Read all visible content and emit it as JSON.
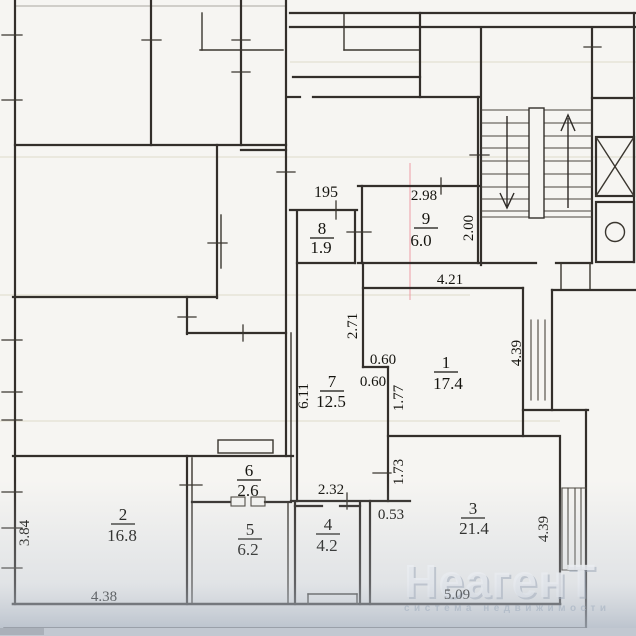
{
  "apartment_number": "195",
  "rooms": [
    {
      "number": "1",
      "area": "17.4"
    },
    {
      "number": "2",
      "area": "16.8"
    },
    {
      "number": "3",
      "area": "21.4"
    },
    {
      "number": "4",
      "area": "4.2"
    },
    {
      "number": "5",
      "area": "6.2"
    },
    {
      "number": "6",
      "area": "2.6"
    },
    {
      "number": "7",
      "area": "12.5"
    },
    {
      "number": "8",
      "area": "1.9"
    },
    {
      "number": "9",
      "area": "6.0"
    }
  ],
  "dimensions": [
    {
      "value": "2.98"
    },
    {
      "value": "2.00"
    },
    {
      "value": "4.21"
    },
    {
      "value": "2.71"
    },
    {
      "value": "0.60"
    },
    {
      "value": "0.60"
    },
    {
      "value": "1.77"
    },
    {
      "value": "4.39"
    },
    {
      "value": "6.11"
    },
    {
      "value": "2.32"
    },
    {
      "value": "1.73"
    },
    {
      "value": "0.53"
    },
    {
      "value": "3.84"
    },
    {
      "value": "4.38"
    },
    {
      "value": "5.09"
    },
    {
      "value": "4.39"
    }
  ],
  "watermark": {
    "brand": "НеагенТ",
    "tagline": "система недвижимости"
  },
  "colors": {
    "paper": "#f6f5f2",
    "ink": "#332f2b",
    "shadow_band": "#c2c8d1",
    "watermark_text": "#ffffff",
    "tagline_text": "#b7c2cd"
  }
}
